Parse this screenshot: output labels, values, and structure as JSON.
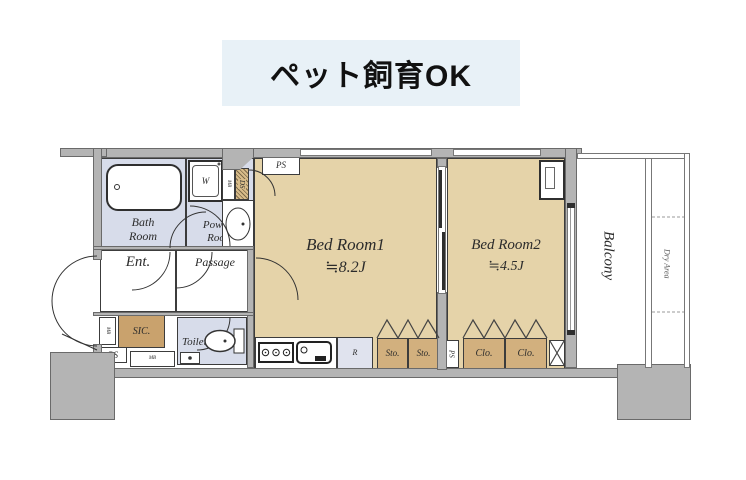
{
  "banner": {
    "label": "ペット飼育OK"
  },
  "plan": {
    "rooms": {
      "bath": {
        "label": "Bath\nRoom"
      },
      "powder": {
        "label": "Powder\nRoom"
      },
      "entrance": {
        "label": "Ent."
      },
      "passage": {
        "label": "Passage"
      },
      "sic": {
        "label": "SIC."
      },
      "toilet": {
        "label": "Toilet"
      },
      "bedroom1": {
        "name": "Bed Room1",
        "area": "≒8.2J"
      },
      "bedroom2": {
        "name": "Bed Room2",
        "area": "≒4.5J"
      },
      "balcony": {
        "label": "Balcony"
      },
      "dry_area": {
        "label": "Dry Area"
      }
    },
    "labels": {
      "ps": "PS",
      "ds": "DS",
      "mb": "MB",
      "washer": "W",
      "fridge": "R",
      "sto": [
        "Sto.",
        "Sto."
      ],
      "clo": [
        "Clo.",
        "Clo."
      ]
    },
    "colors": {
      "wall": "#b4b4b4",
      "room_tan": "#e5d3a9",
      "closet_tan": "#d2b07e",
      "wet_blue": "#d7dcea",
      "fridge_blue": "#e0e3ee",
      "banner_bg": "#e8f1f7"
    }
  }
}
